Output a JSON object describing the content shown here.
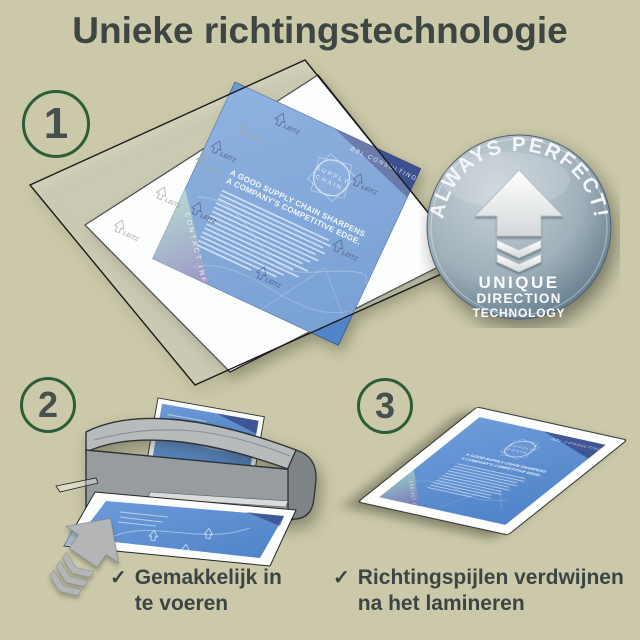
{
  "title": "Unieke richtingstechnologie",
  "colors": {
    "background": "#cbc9a9",
    "text": "#3d4643",
    "circle_ring": "#2c5c38",
    "document_blue": "#5d90d0",
    "navy_corner": "#2b306e",
    "badge_silver": "#9fb0ba",
    "machine_gray": "#979c9f"
  },
  "steps": [
    {
      "number": "1"
    },
    {
      "number": "2"
    },
    {
      "number": "3"
    }
  ],
  "badge": {
    "arc_text": "ALWAYS PERFECT!",
    "line1": "UNIQUE",
    "line2": "DIRECTION",
    "line3": "TECHNOLOGY"
  },
  "document": {
    "brand": "LEITZ",
    "company": "BBL CONSULTING",
    "logo_line1": "SUPPLY",
    "logo_line2": "CHAIN",
    "heading_line1": "A GOOD SUPPLY CHAIN SHARPENS",
    "heading_line2": "A COMPANY'S COMPETITIVE EDGE.",
    "footer": "CONTACT INFO"
  },
  "checklist": [
    {
      "check": "✓",
      "line1": "Gemakkelijk in",
      "line2": "te voeren"
    },
    {
      "check": "✓",
      "line1": "Richtingspijlen verdwijnen",
      "line2": "na het lamineren"
    }
  ]
}
